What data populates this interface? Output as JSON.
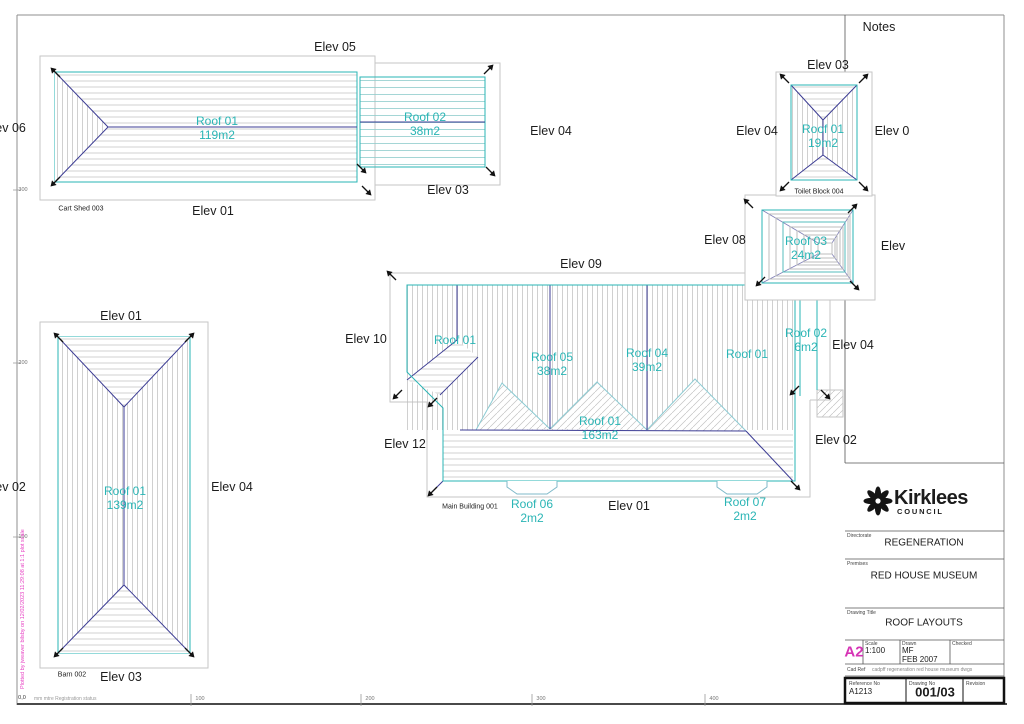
{
  "page": {
    "notes": "Notes"
  },
  "colors": {
    "cyan": "#2ab5b5",
    "ridge": "#3c3c94",
    "outline": "#c6c6c6",
    "magenta": "#d633b5"
  },
  "cart_shed": {
    "name": "Cart Shed 003",
    "elev_top": "Elev 05",
    "elev_left": "Elev 06",
    "elev_right": "Elev 04",
    "elev_inner": "Elev 03",
    "elev_bottom": "Elev 01",
    "roof1_name": "Roof 01",
    "roof1_area": "119m2",
    "roof2_name": "Roof 02",
    "roof2_area": "38m2"
  },
  "toilet_block": {
    "name": "Toilet Block 004",
    "elev_top": "Elev 03",
    "elev_left": "Elev 04",
    "elev_right": "Elev 0",
    "roof_name": "Roof 01",
    "roof_area": "19m2"
  },
  "roof03_block": {
    "elev_left": "Elev 08",
    "elev_right": "Elev",
    "roof_name": "Roof 03",
    "roof_area": "24m2"
  },
  "main_building": {
    "name": "Main Building 001",
    "elev_top": "Elev 09",
    "elev_left_upper": "Elev 10",
    "elev_left_lower": "Elev 12",
    "elev_bottom": "Elev 01",
    "elev_right_upper": "Elev 04",
    "elev_right_lower": "Elev 02",
    "roof_wing": "Roof 01",
    "roof05_name": "Roof 05",
    "roof05_area": "38m2",
    "roof04_name": "Roof 04",
    "roof04_area": "39m2",
    "roof01_right": "Roof 01",
    "roof02_name": "Roof 02",
    "roof02_area": "6m2",
    "roof01_center_name": "Roof 01",
    "roof01_center_area": "163m2",
    "roof06_name": "Roof 06",
    "roof06_area": "2m2",
    "roof07_name": "Roof 07",
    "roof07_area": "2m2"
  },
  "barn": {
    "name": "Barn 002",
    "elev_top": "Elev 01",
    "elev_left": "Elev 02",
    "elev_right": "Elev 04",
    "elev_bottom": "Elev 03",
    "roof_name": "Roof 01",
    "roof_area": "139m2"
  },
  "rulers": {
    "left_ticks": [
      "300",
      "200",
      "100"
    ],
    "bottom_ticks": [
      "100",
      "200",
      "300",
      "400"
    ],
    "origin": "0,0",
    "origin_note": "mm mtre Registration status",
    "plot_note": "Plotted by jweaver bilsby on 12/02/2023 11:29:08 at 1:1 plot scale"
  },
  "title_block": {
    "logo_text": "Kirklees",
    "logo_sub": "COUNCIL",
    "directorate_label": "Directorate",
    "directorate": "REGENERATION",
    "premises_label": "Premises",
    "premises": "RED HOUSE MUSEUM",
    "drawing_title_label": "Drawing Title",
    "drawing_title": "ROOF LAYOUTS",
    "sheet_size": "A2",
    "scale_label": "Scale",
    "scale": "1:100",
    "drawn_label": "Drawn",
    "drawn": "MF",
    "date": "FEB 2007",
    "checked_label": "Checked",
    "checked": "",
    "cad_ref_label": "Cad Ref",
    "cad_ref": "cadpff regeneration red house museum dwgs",
    "reference_label": "Reference No",
    "reference": "A1213",
    "drawing_no_label": "Drawing No",
    "drawing_no": "001/03",
    "revision_label": "Revision",
    "revision": ""
  }
}
